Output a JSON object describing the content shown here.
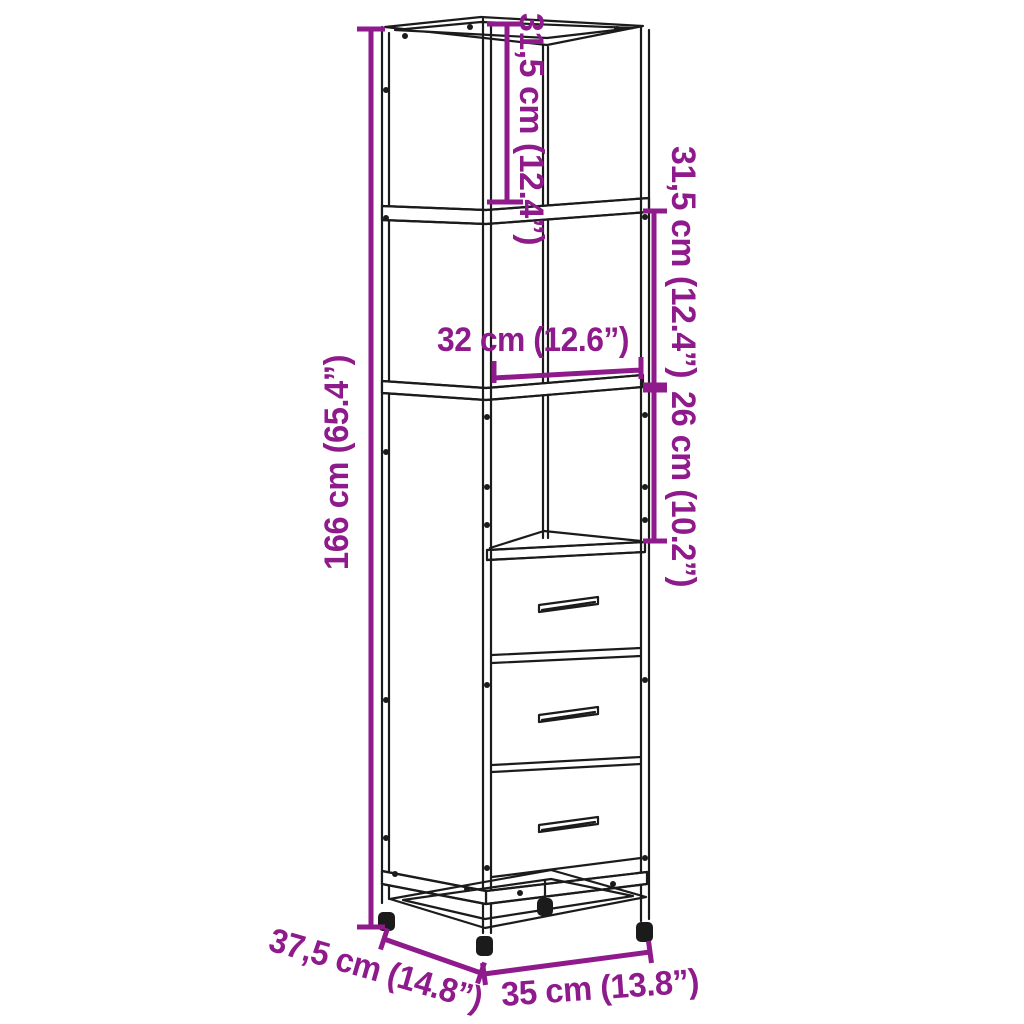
{
  "diagram": {
    "figure": "tall-cabinet-with-drawers-line-drawing",
    "colors": {
      "line": "#1b1b1b",
      "dimension": "#8E1A8C",
      "background": "#ffffff"
    },
    "dimensions": {
      "top_section_height": "31,5 cm (12.4”)",
      "middle_section_height": "31,5 cm (12.4”)",
      "shelf_width": "32 cm (12.6”)",
      "lower_shelf_height": "26 cm (10.2”)",
      "total_height": "166 cm (65.4”)",
      "depth": "37,5 cm (14.8”)",
      "width": "35 cm (13.8”)"
    }
  }
}
